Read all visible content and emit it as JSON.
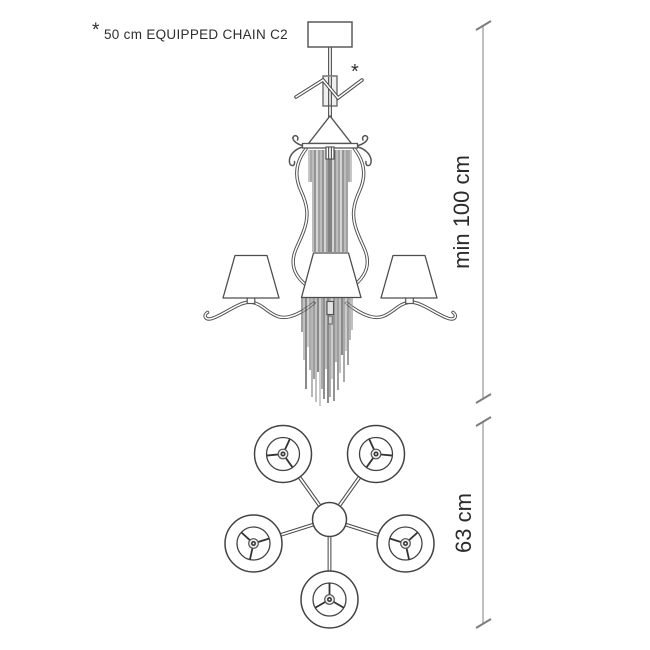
{
  "note": {
    "marker": "*",
    "text": "50 cm EQUIPPED CHAIN C2"
  },
  "elevation": {
    "description": "chandelier side elevation with chain fringe, 3 visible shades",
    "asterisk": "*",
    "height_dimension": "min 100 cm"
  },
  "plan": {
    "description": "chandelier top view, 5 shades on radial arms",
    "arm_count": 5,
    "width_dimension": "63 cm"
  },
  "colors": {
    "background": "#ffffff",
    "outline": "#4f4f4f",
    "dimension_line": "#acacac",
    "text": "#2e2e2e"
  }
}
